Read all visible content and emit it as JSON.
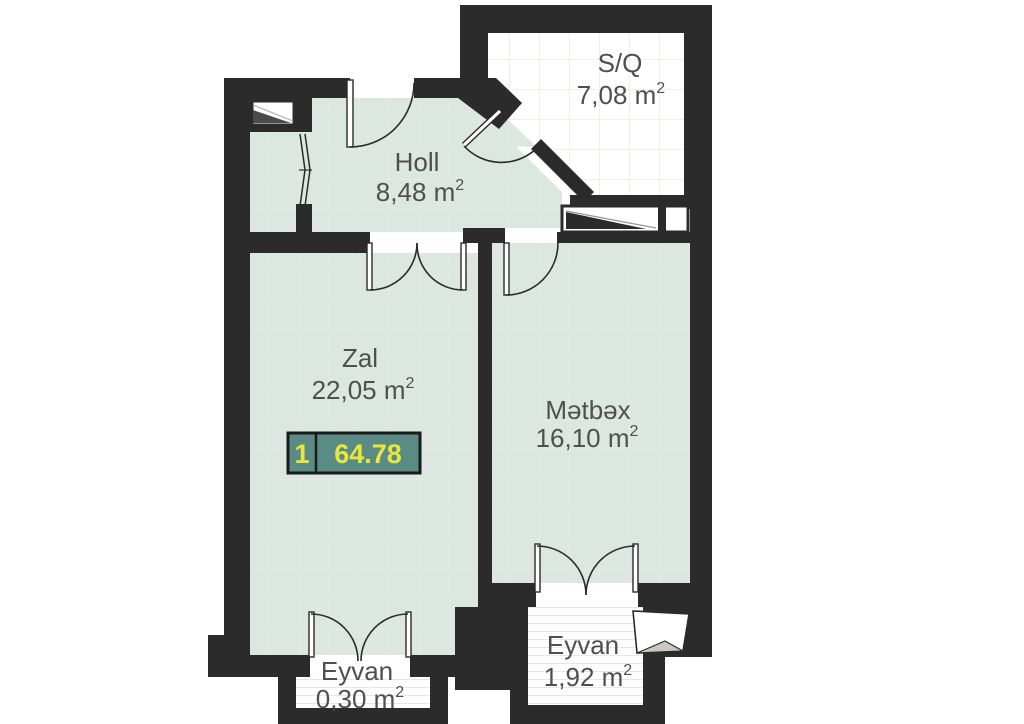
{
  "rooms": [
    {
      "name": "S/Q",
      "area": "7,08 m",
      "sup": "2"
    },
    {
      "name": "Holl",
      "area": "8,48 m",
      "sup": "2"
    },
    {
      "name": "Zal",
      "area": "22,05  m",
      "sup": "2"
    },
    {
      "name": "Mətbəx",
      "area": "16,10 m",
      "sup": "2"
    },
    {
      "name": "Eyvan",
      "area": "0,30 m",
      "sup": "2"
    },
    {
      "name": "Eyvan",
      "area": "1,92 m",
      "sup": "2"
    }
  ],
  "badge": {
    "unit_number": "1",
    "total_area": "64.78"
  },
  "colors": {
    "wall": "#2b2b2b",
    "floor": "#dce7e2",
    "sq_floor": "#ffffff",
    "badge_fill": "#5a8b85",
    "badge_border": "#1a1a1a",
    "badge_text": "#e9e73b",
    "label_text": "#4f4f4f"
  }
}
